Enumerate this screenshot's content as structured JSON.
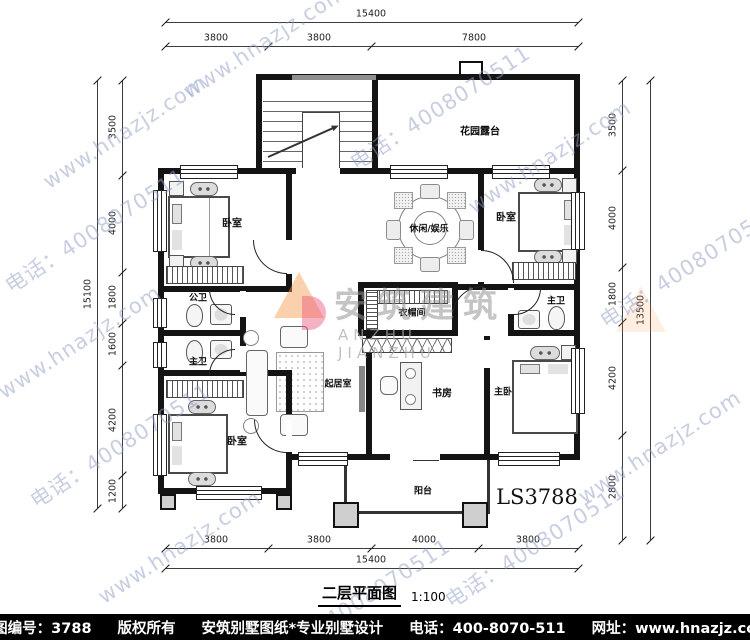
{
  "watermark": {
    "site": "www.hnazjz.com",
    "phone": "电话：4008070511"
  },
  "logo": {
    "cn": "安筑建筑",
    "en": "ANZHU JIANZHU"
  },
  "plan_code": "LS3788",
  "title": {
    "text": "二层平面图",
    "scale": "1:100"
  },
  "rooms": {
    "garden_terrace": "花园露台",
    "bedroom_tl": "卧室",
    "bedroom_tr": "卧室",
    "leisure": "休闲/娱乐",
    "public_bath": "公卫",
    "master_bath_left": "主卫",
    "cloakroom": "衣帽间",
    "living": "起居室",
    "study": "书房",
    "master_bedroom": "主卧",
    "master_bath_right": "主卫",
    "bedroom_bl": "卧室",
    "balcony": "阳台"
  },
  "dims": {
    "top": {
      "total": "15400",
      "segments": [
        "3800",
        "3800",
        "7800"
      ]
    },
    "bottom": {
      "total": "15400",
      "segments": [
        "3800",
        "3800",
        "4000",
        "3800"
      ]
    },
    "left": {
      "total": "15100",
      "segments": [
        "3500",
        "4000",
        "1800",
        "1600",
        "4200",
        "1200"
      ]
    },
    "right": {
      "total": "13500",
      "segments": [
        "3500",
        "4000",
        "1800",
        "4200",
        "2800"
      ]
    }
  },
  "footer": {
    "number": "本图编号：3788",
    "copyright": "版权所有",
    "brand": "安筑别墅图纸*专业别墅设计",
    "phone": "电话：400-8070-511",
    "site": "网址：www.hnazjz.com"
  }
}
